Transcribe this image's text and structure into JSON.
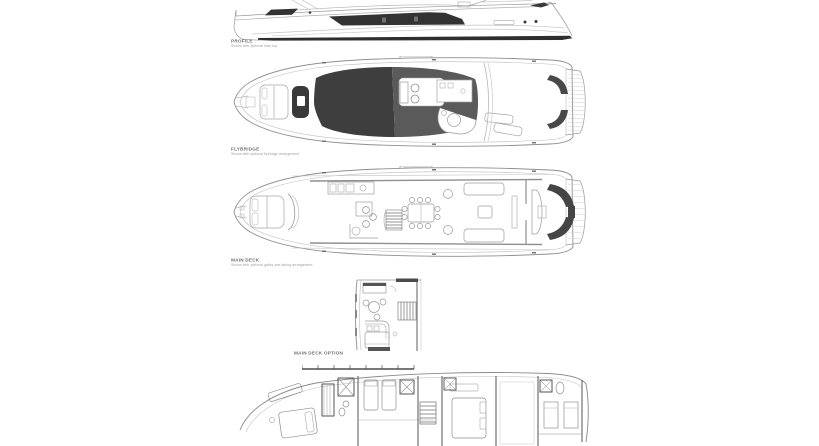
{
  "page": {
    "background": "#ffffff"
  },
  "palette": {
    "linework": "#9a9a9a",
    "light_linework": "#c4c4c4",
    "dark_glass": "#333333",
    "shade_dark": "#3e3e3e",
    "shade_mid": "#5a5a5a",
    "stair_dark": "#484848",
    "label_title": "#6f6f6f",
    "label_subtitle": "#9b9b9b"
  },
  "sections": {
    "profile": {
      "title": "PROFILE",
      "subtitle": "Shown with optional hard top"
    },
    "flybridge": {
      "title": "FLYBRIDGE",
      "subtitle": "Shown with optional flybridge arrangement"
    },
    "main_deck": {
      "title": "MAIN DECK",
      "subtitle": "Shown with optional galley and dining arrangement"
    },
    "main_deck_option": {
      "title": "MAIN DECK OPTION"
    }
  }
}
